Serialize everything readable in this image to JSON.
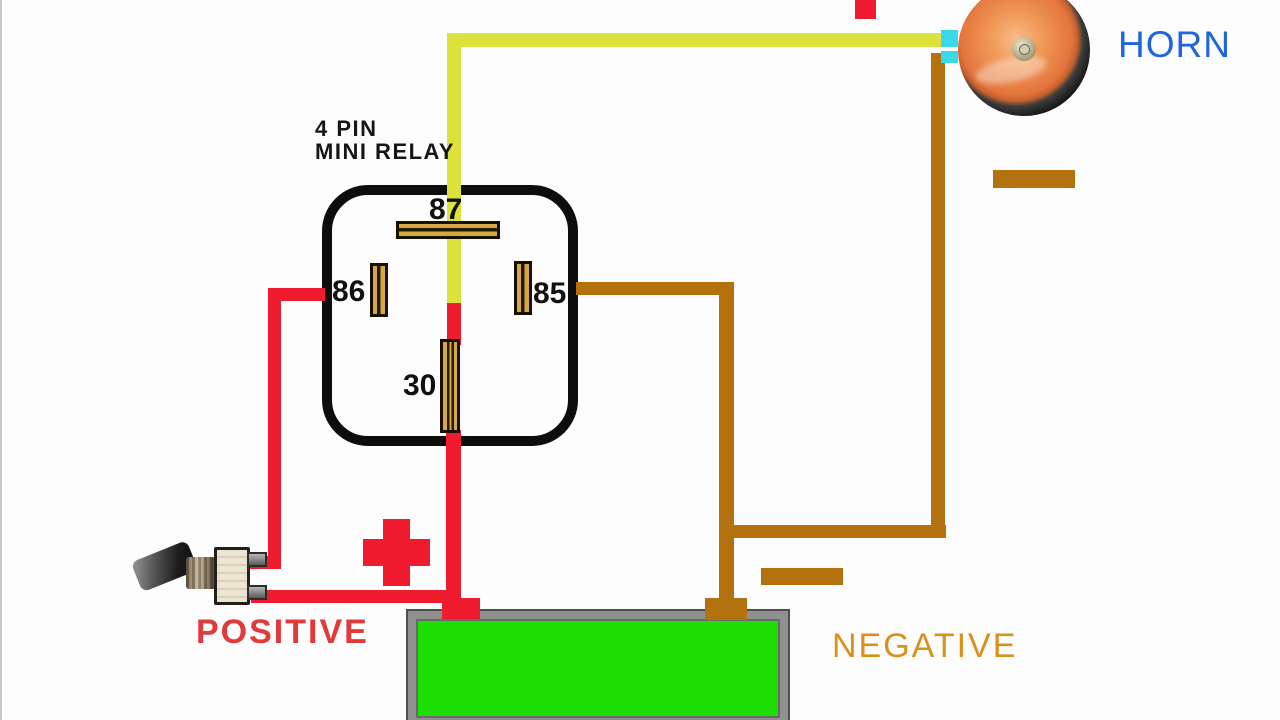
{
  "relay": {
    "title_line1": "4 PIN",
    "title_line2": "MINI RELAY",
    "pins": {
      "p87": "87",
      "p86": "86",
      "p85": "85",
      "p30": "30"
    }
  },
  "labels": {
    "horn": "HORN",
    "positive": "POSITIVE",
    "negative": "NEGATIVE"
  },
  "colors": {
    "wire_yellow": "#dce23c",
    "wire_red": "#ee1c2e",
    "wire_brown": "#b4720e",
    "battery_green": "#1ddf04",
    "horn_terminal_cyan": "#3ad8e8",
    "horn_text_blue": "#2065dd",
    "positive_text_red": "#e03a3a",
    "negative_text_orange": "#d8921c",
    "relay_outline_black": "#0d0d0d",
    "pin_gold": "#d4a843"
  }
}
